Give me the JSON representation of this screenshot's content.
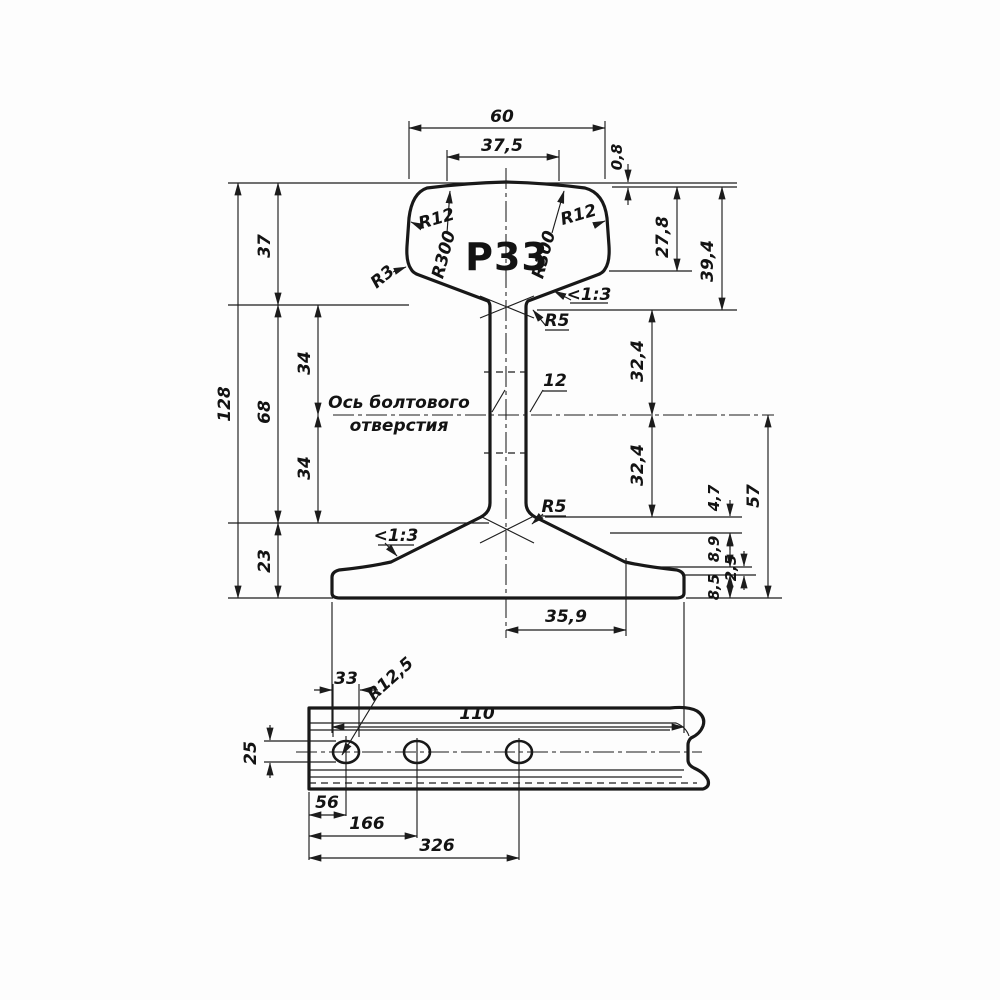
{
  "drawing": {
    "profile_label": "Р33",
    "cross_section": {
      "top_width": "60",
      "crown_width": "37,5",
      "crown_drop": "0,8",
      "head_side_height": "27,8",
      "head_total_height": "39,4",
      "head_zone_height": "37",
      "overall_height": "128",
      "web_zone_height": "68",
      "axis_to_head": "34",
      "axis_to_foot": "34",
      "foot_zone_height": "23",
      "web_upper_height": "32,4",
      "web_lower_height": "32,4",
      "fillet_drop": "4,7",
      "axis_to_base": "57",
      "foot_slope_drop": "8,9",
      "foot_edge_step": "2,5",
      "foot_edge_thickness": "8,5",
      "foot_half_width": "35,9",
      "foot_width": "110",
      "web_thickness": "12",
      "radius_head_corner_left": "R12",
      "radius_head_corner_right": "R12",
      "radius_crown_left": "R300",
      "radius_crown_right": "R300",
      "radius_head_bottom": "R3",
      "radius_web_top": "R5",
      "radius_web_bottom": "R5",
      "head_slope": "<1:3",
      "foot_slope": "<1:3",
      "bolt_axis_line1": "Ось болтового",
      "bolt_axis_line2": "отверстия"
    },
    "side_view": {
      "hole_length": "33",
      "hole_end_radius": "R12,5",
      "hole_height": "25",
      "first_hole_offset": "56",
      "second_hole_offset": "166",
      "third_hole_offset": "326"
    }
  }
}
